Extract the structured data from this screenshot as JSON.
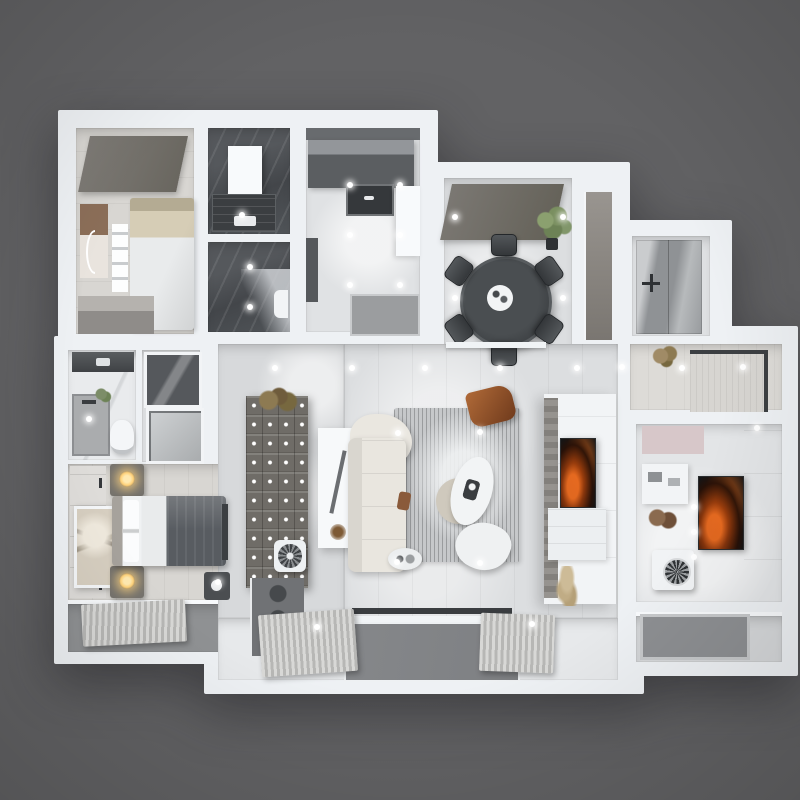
{
  "scene": {
    "description": "3D top-down architectural render of an apartment floor plan on a plain dark gray backdrop",
    "background": "#626264"
  },
  "palette": {
    "bg": "#626264",
    "wall": "#eef1f4",
    "wall_bright": "#f8fafc",
    "floor": "#dcdee0",
    "floor_warm": "#d8d6d2",
    "tile_dark": "#4a4d51",
    "marble": "#e9ebed",
    "slab": "#75726d",
    "rug": "#c6c8ca",
    "sofa": "#e9e6df",
    "blanket": "#585c61",
    "accent_orange": "#c2571f",
    "lamp": "#ffd27a",
    "green": "#7c8d68",
    "deck_a": "#d8d8d6",
    "deck_b": "#b7b7b5",
    "glass": "#85878a",
    "mirror": "#a9acaf",
    "pink": "#d7c7c9",
    "dark_cab": "#6f6c67",
    "fan": "#3f4245"
  },
  "rooms": [
    {
      "id": "bedroom-secondary",
      "contents": [
        "recessed-ceiling-panel",
        "bed",
        "pillows",
        "arc-light-wall-art",
        "storage-shelf",
        "wardrobe"
      ]
    },
    {
      "id": "bathroom-shower",
      "contents": [
        "dark-marble-tile",
        "door-panel",
        "shower-tray",
        "bath-mat"
      ]
    },
    {
      "id": "bathroom-wc",
      "contents": [
        "dark-marble-tile",
        "toilet"
      ]
    },
    {
      "id": "kitchen",
      "contents": [
        "dark-counter",
        "sink",
        "tall-cabinet",
        "white-counter-return",
        "floor-mat"
      ]
    },
    {
      "id": "dining-room",
      "contents": [
        "recessed-ceiling-panel",
        "round-dining-table",
        "six-dining-chairs",
        "serving-tray",
        "potted-plant",
        "sideboard",
        "gray-door"
      ]
    },
    {
      "id": "entry-closet",
      "contents": [
        "mirror-wardrobe",
        "cross-door-handle"
      ]
    },
    {
      "id": "entry-hall",
      "contents": [
        "bordered-rug",
        "dried-plant"
      ]
    },
    {
      "id": "bedroom-study",
      "contents": [
        "pink-ceiling-panel",
        "wall-shelf",
        "orange-art-tv",
        "portable-ac-fan",
        "wall-decor",
        "balcony-mat"
      ]
    },
    {
      "id": "bedroom-primary",
      "contents": [
        "wardrobe-panels",
        "framed-abstract-art",
        "bed-with-dark-blanket",
        "two-glowing-nightstand-lamps",
        "foot-bench",
        "ac-unit",
        "deck-balcony"
      ]
    },
    {
      "id": "bathroom-ensuite",
      "contents": [
        "vanity-counter",
        "shower",
        "toilet",
        "plant"
      ]
    },
    {
      "id": "closet-nook",
      "contents": [
        "framed-photo",
        "framed-window"
      ]
    },
    {
      "id": "hallway",
      "contents": [
        "compartment-shelf-wall",
        "console-island",
        "floor-fan",
        "media-cabinet",
        "dried-plant"
      ]
    },
    {
      "id": "living-room",
      "contents": [
        "sectional-sofa",
        "striped-rug",
        "oval-coffee-table",
        "round-side-table",
        "lounge-chair",
        "rust-accent-chair",
        "tv-media-wall",
        "orange-art-tv",
        "media-console",
        "pampas-grass",
        "window-track"
      ]
    },
    {
      "id": "balcony-south",
      "contents": [
        "wood-deck-mats",
        "glass-panel"
      ]
    }
  ],
  "ceiling_lights": [
    [
      242,
      215
    ],
    [
      250,
      267
    ],
    [
      250,
      307
    ],
    [
      350,
      185
    ],
    [
      400,
      185
    ],
    [
      350,
      235
    ],
    [
      400,
      235
    ],
    [
      350,
      285
    ],
    [
      400,
      285
    ],
    [
      455,
      217
    ],
    [
      563,
      217
    ],
    [
      455,
      298
    ],
    [
      563,
      298
    ],
    [
      275,
      368
    ],
    [
      352,
      368
    ],
    [
      425,
      368
    ],
    [
      500,
      368
    ],
    [
      577,
      368
    ],
    [
      622,
      367
    ],
    [
      682,
      368
    ],
    [
      743,
      367
    ],
    [
      398,
      433
    ],
    [
      480,
      432
    ],
    [
      397,
      562
    ],
    [
      480,
      563
    ],
    [
      317,
      627
    ],
    [
      532,
      624
    ],
    [
      694,
      507
    ],
    [
      694,
      532
    ],
    [
      694,
      557
    ],
    [
      757,
      428
    ],
    [
      89,
      419
    ],
    [
      218,
      582
    ]
  ]
}
